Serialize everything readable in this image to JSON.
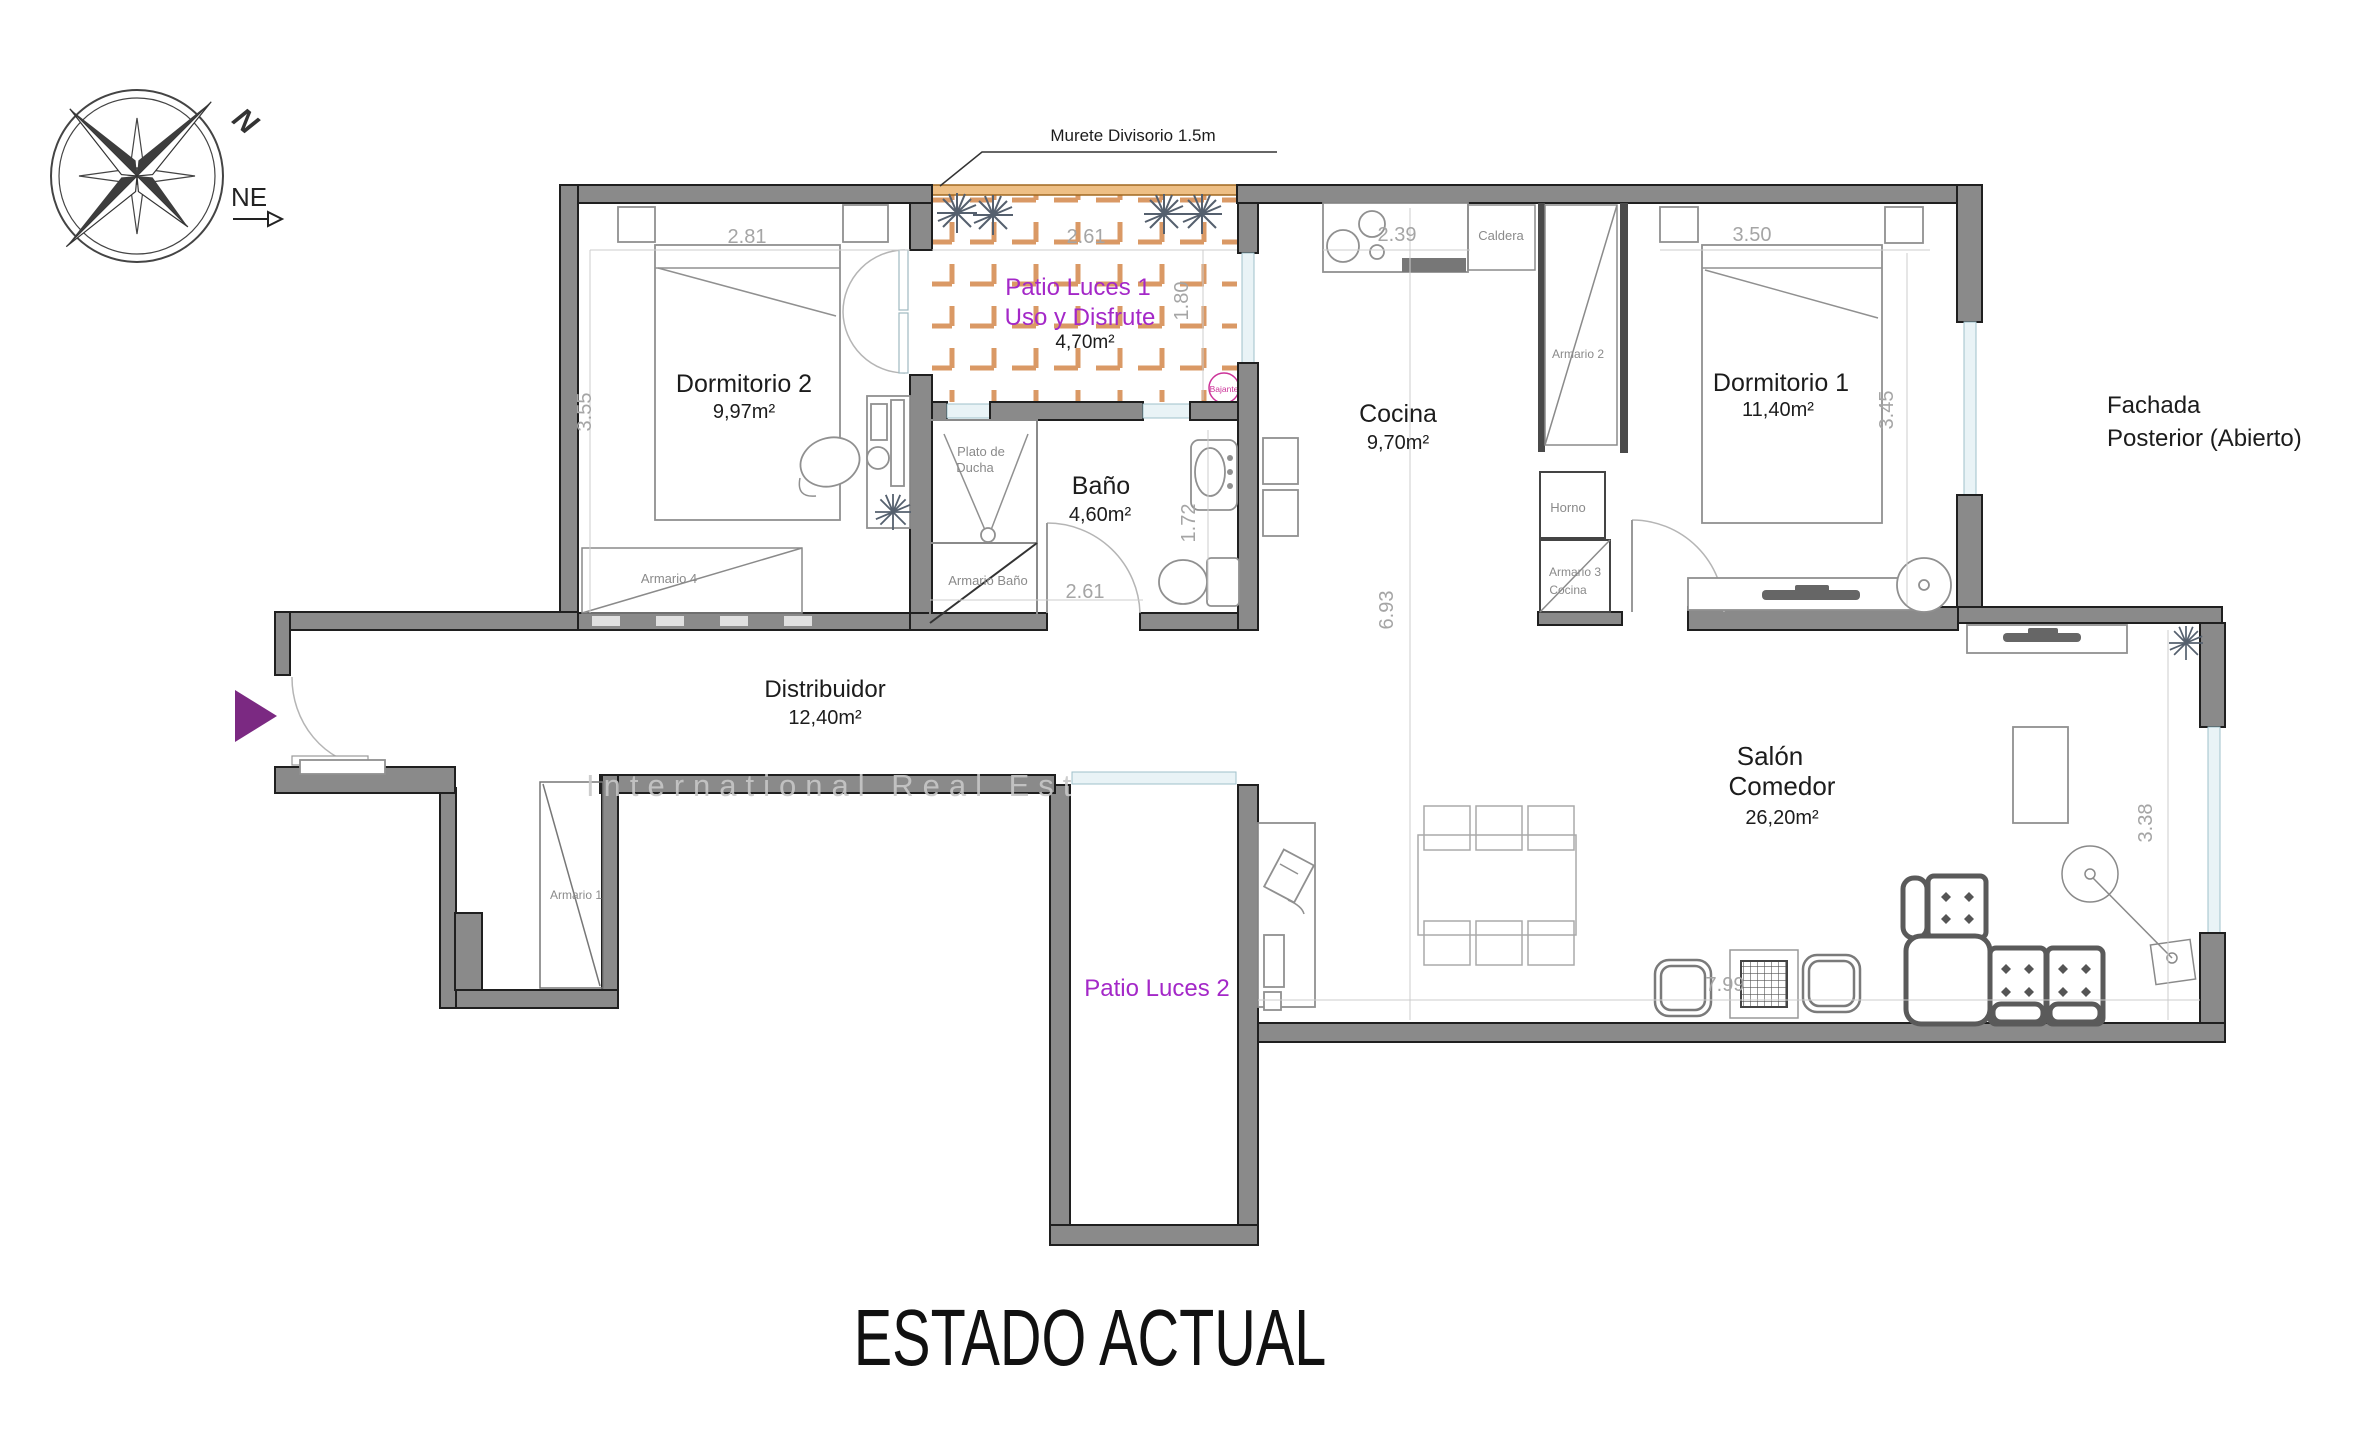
{
  "title": "ESTADO ACTUAL",
  "compass": {
    "n": "N",
    "ne": "NE"
  },
  "annotations": {
    "murete": "Murete Divisorio 1.5m",
    "fachada_line1": "Fachada",
    "fachada_line2": "Posterior (Abierto)",
    "watermark": "International Real Est"
  },
  "rooms": {
    "dormitorio2": {
      "name": "Dormitorio 2",
      "area": "9,97m²"
    },
    "dormitorio1": {
      "name": "Dormitorio 1",
      "area": "11,40m²"
    },
    "bano": {
      "name": "Baño",
      "area": "4,60m²"
    },
    "cocina": {
      "name": "Cocina",
      "area": "9,70m²"
    },
    "distribuidor": {
      "name": "Distribuidor",
      "area": "12,40m²"
    },
    "salon": {
      "name_line1": "Salón",
      "name_line2": "Comedor",
      "area": "26,20m²"
    },
    "patio1": {
      "name": "Patio Luces 1",
      "subtitle": "Uso y Disfrute",
      "area": "4,70m²"
    },
    "patio2": {
      "name": "Patio Luces 2"
    }
  },
  "fixtures": {
    "armario1": "Armario 1",
    "armario2": "Armario 2",
    "armario3_line1": "Armario 3",
    "armario3_line2": "Cocina",
    "armario4": "Armario 4",
    "armario_bano": "Armario Baño",
    "plato_line1": "Plato de",
    "plato_line2": "Ducha",
    "caldera": "Caldera",
    "horno": "Horno",
    "bajante": "Bajante"
  },
  "dimensions": {
    "dorm2_w": "2.81",
    "dorm2_h": "3.55",
    "patio1_w": "2.61",
    "patio1_h": "1.80",
    "cocina_w": "2.39",
    "dorm1_w": "3.50",
    "dorm1_h": "3.45",
    "bano_w": "2.61",
    "bano_h": "1.72",
    "salon_len": "6.93",
    "salon_w": "7.99",
    "salon_h": "3.38"
  },
  "colors": {
    "wall": "#8a8a8a",
    "patio_text": "#a428c8",
    "bajante_magenta": "#cc3399",
    "murete_orange": "#eebf85",
    "hatch_orange": "#d1803f",
    "entrance_arrow": "#7b2982",
    "dim_text": "#a5a5a5"
  }
}
